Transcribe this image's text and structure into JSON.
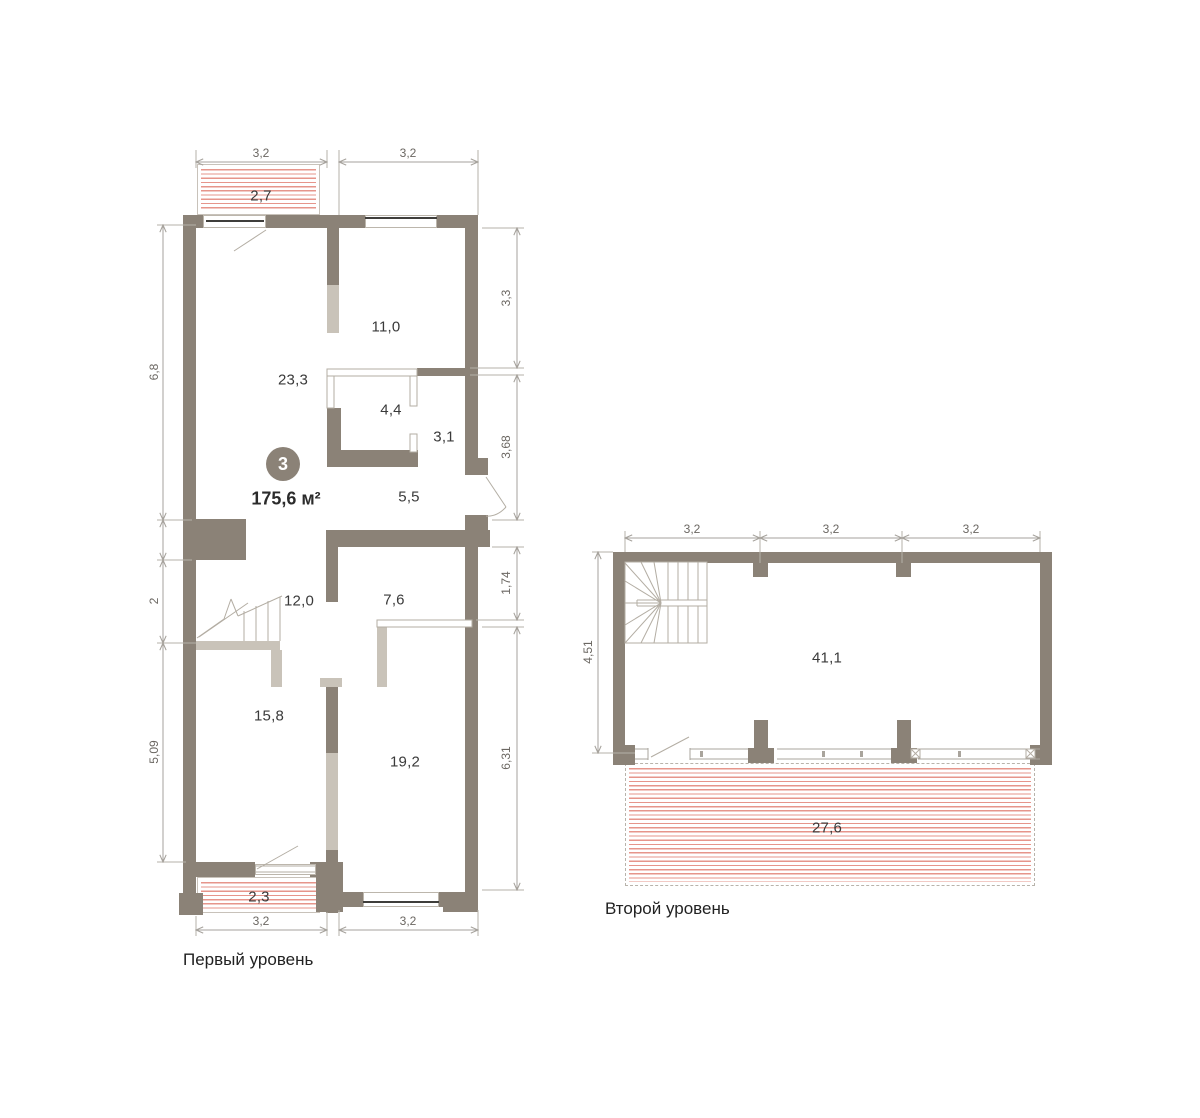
{
  "unit": {
    "number": "3",
    "area": "175,6 м²"
  },
  "levels": {
    "level1": {
      "label": "Первый уровень",
      "rooms": [
        {
          "name": "balcony-top",
          "area": "2,7"
        },
        {
          "name": "living-room",
          "area": "23,3"
        },
        {
          "name": "room-top-right",
          "area": "11,0"
        },
        {
          "name": "bathroom",
          "area": "4,4"
        },
        {
          "name": "wc",
          "area": "3,1"
        },
        {
          "name": "hallway",
          "area": "5,5"
        },
        {
          "name": "stair-hall",
          "area": "12,0"
        },
        {
          "name": "corridor",
          "area": "7,6"
        },
        {
          "name": "room-bottom-left",
          "area": "15,8"
        },
        {
          "name": "room-bottom-right",
          "area": "19,2"
        },
        {
          "name": "balcony-bottom",
          "area": "2,3"
        }
      ],
      "dims": {
        "top": [
          "3,2",
          "3,2"
        ],
        "bottom": [
          "3,2",
          "3,2"
        ],
        "left": [
          "6,8",
          "2",
          "5,09"
        ],
        "right": [
          "3,3",
          "3,68",
          "1,74",
          "6,31"
        ]
      }
    },
    "level2": {
      "label": "Второй уровень",
      "rooms": [
        {
          "name": "studio",
          "area": "41,1"
        },
        {
          "name": "terrace",
          "area": "27,6"
        }
      ],
      "dims": {
        "top": [
          "3,2",
          "3,2",
          "3,2"
        ],
        "left": [
          "4,51"
        ]
      }
    }
  },
  "colors": {
    "wall_dark": "#8b8277",
    "wall_light": "#c9c3b9",
    "hatch_red": "#e6958b",
    "dim_line": "#a6a29c",
    "label_text": "#3a3a3a"
  }
}
